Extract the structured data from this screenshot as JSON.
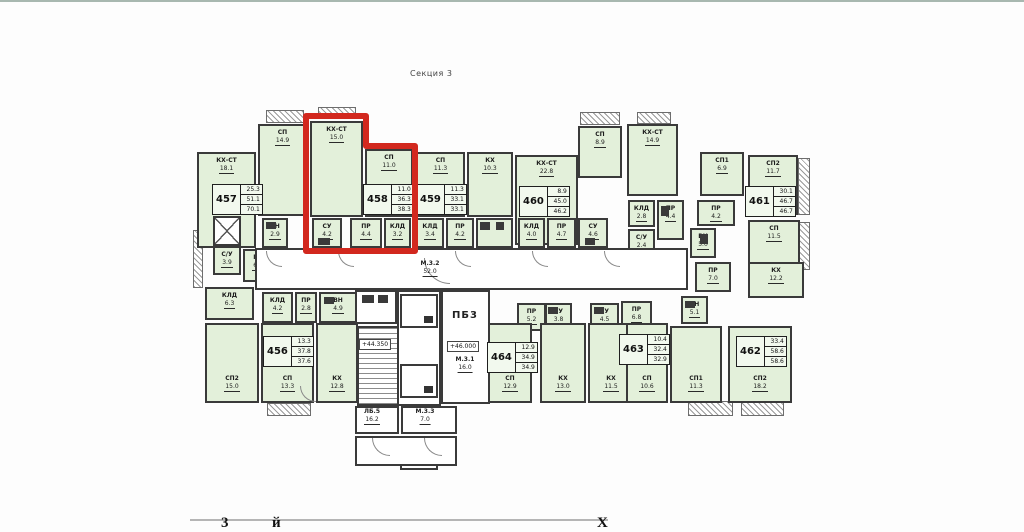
{
  "title": "Секция 3",
  "highlight": {
    "apartment": "458",
    "color": "#d2281e"
  },
  "rooms": [
    {
      "nm": "КХ-СТ",
      "ar": "18.1",
      "x": 197,
      "y": 152,
      "w": 59,
      "h": 96
    },
    {
      "nm": "СП",
      "ar": "14.9",
      "x": 258,
      "y": 124,
      "w": 49,
      "h": 92
    },
    {
      "nm": "КХ-СТ",
      "ar": "15.0",
      "x": 310,
      "y": 121,
      "w": 53,
      "h": 96
    },
    {
      "nm": "СП",
      "ar": "11.0",
      "x": 365,
      "y": 149,
      "w": 48,
      "h": 68
    },
    {
      "nm": "СП",
      "ar": "11.3",
      "x": 416,
      "y": 152,
      "w": 49,
      "h": 65
    },
    {
      "nm": "КХ",
      "ar": "10.3",
      "x": 467,
      "y": 152,
      "w": 46,
      "h": 65
    },
    {
      "nm": "КХ-СТ",
      "ar": "22.8",
      "x": 515,
      "y": 155,
      "w": 63,
      "h": 90
    },
    {
      "nm": "СП",
      "ar": "8.9",
      "x": 578,
      "y": 126,
      "w": 44,
      "h": 52
    },
    {
      "nm": "КХ-СТ",
      "ar": "14.9",
      "x": 627,
      "y": 124,
      "w": 51,
      "h": 72
    },
    {
      "nm": "СП1",
      "ar": "6.9",
      "x": 700,
      "y": 152,
      "w": 44,
      "h": 44
    },
    {
      "nm": "СП2",
      "ar": "11.7",
      "x": 748,
      "y": 155,
      "w": 50,
      "h": 60
    },
    {
      "nm": "СП",
      "ar": "11.5",
      "x": 748,
      "y": 220,
      "w": 52,
      "h": 50
    },
    {
      "nm": "ВН",
      "ar": "2.9",
      "x": 262,
      "y": 218,
      "w": 26,
      "h": 30
    },
    {
      "nm": "СУ",
      "ar": "4.2",
      "x": 312,
      "y": 218,
      "w": 30,
      "h": 30
    },
    {
      "nm": "ПР",
      "ar": "4.4",
      "x": 350,
      "y": 218,
      "w": 32,
      "h": 30
    },
    {
      "nm": "КЛД",
      "ar": "3.2",
      "x": 384,
      "y": 218,
      "w": 27,
      "h": 30
    },
    {
      "nm": "КЛД",
      "ar": "3.4",
      "x": 416,
      "y": 218,
      "w": 28,
      "h": 30
    },
    {
      "nm": "ПР",
      "ar": "4.2",
      "x": 446,
      "y": 218,
      "w": 28,
      "h": 30
    },
    {
      "nm": "",
      "ar": "",
      "x": 476,
      "y": 218,
      "w": 37,
      "h": 30
    },
    {
      "nm": "КЛД",
      "ar": "4.0",
      "x": 518,
      "y": 218,
      "w": 27,
      "h": 30
    },
    {
      "nm": "ПР",
      "ar": "4.7",
      "x": 547,
      "y": 218,
      "w": 29,
      "h": 30
    },
    {
      "nm": "СУ",
      "ar": "4.6",
      "x": 578,
      "y": 218,
      "w": 30,
      "h": 30
    },
    {
      "nm": "КЛД",
      "ar": "2.8",
      "x": 628,
      "y": 200,
      "w": 27,
      "h": 27
    },
    {
      "nm": "ПР",
      "ar": "4.4",
      "x": 657,
      "y": 200,
      "w": 27,
      "h": 40
    },
    {
      "nm": "С/У",
      "ar": "2.4",
      "x": 628,
      "y": 229,
      "w": 27,
      "h": 26
    },
    {
      "nm": "ПР",
      "ar": "4.2",
      "x": 697,
      "y": 200,
      "w": 38,
      "h": 26
    },
    {
      "nm": "ВН",
      "ar": "5.0",
      "x": 690,
      "y": 228,
      "w": 26,
      "h": 30
    },
    {
      "nm": "С/У",
      "ar": "3.9",
      "x": 213,
      "y": 246,
      "w": 28,
      "h": 29
    },
    {
      "nm": "ПР",
      "ar": "6.0",
      "x": 243,
      "y": 249,
      "w": 30,
      "h": 33
    },
    {
      "nm": "КЛД",
      "ar": "6.3",
      "x": 205,
      "y": 287,
      "w": 49,
      "h": 33
    },
    {
      "nm": "КЛД",
      "ar": "4.2",
      "x": 262,
      "y": 292,
      "w": 31,
      "h": 31
    },
    {
      "nm": "ПР",
      "ar": "2.8",
      "x": 295,
      "y": 292,
      "w": 22,
      "h": 31
    },
    {
      "nm": "ВН",
      "ar": "4.9",
      "x": 319,
      "y": 292,
      "w": 38,
      "h": 31
    },
    {
      "nm": "СП2",
      "ar": "15.0",
      "x": 205,
      "y": 323,
      "w": 54,
      "h": 80,
      "cls": "lb"
    },
    {
      "nm": "СП",
      "ar": "13.3",
      "x": 261,
      "y": 323,
      "w": 53,
      "h": 80,
      "cls": "lb"
    },
    {
      "nm": "КХ",
      "ar": "12.8",
      "x": 316,
      "y": 323,
      "w": 42,
      "h": 80,
      "cls": "lb"
    },
    {
      "nm": "ПР",
      "ar": "5.2",
      "x": 517,
      "y": 303,
      "w": 29,
      "h": 28
    },
    {
      "nm": "СУ",
      "ar": "3.8",
      "x": 545,
      "y": 303,
      "w": 27,
      "h": 28
    },
    {
      "nm": "СП",
      "ar": "12.9",
      "x": 488,
      "y": 323,
      "w": 44,
      "h": 80,
      "cls": "lb"
    },
    {
      "nm": "КХ",
      "ar": "13.0",
      "x": 540,
      "y": 323,
      "w": 46,
      "h": 80,
      "cls": "lb"
    },
    {
      "nm": "СУ",
      "ar": "4.5",
      "x": 590,
      "y": 303,
      "w": 29,
      "h": 28
    },
    {
      "nm": "ПР",
      "ar": "6.8",
      "x": 621,
      "y": 301,
      "w": 31,
      "h": 30
    },
    {
      "nm": "КХ",
      "ar": "11.5",
      "x": 588,
      "y": 323,
      "w": 46,
      "h": 80,
      "cls": "lb"
    },
    {
      "nm": "СП",
      "ar": "10.6",
      "x": 626,
      "y": 323,
      "w": 42,
      "h": 80,
      "cls": "lb"
    },
    {
      "nm": "ПР",
      "ar": "7.0",
      "x": 695,
      "y": 262,
      "w": 36,
      "h": 30
    },
    {
      "nm": "КХ",
      "ar": "12.2",
      "x": 748,
      "y": 262,
      "w": 56,
      "h": 36
    },
    {
      "nm": "ВН",
      "ar": "5.1",
      "x": 681,
      "y": 296,
      "w": 27,
      "h": 28
    },
    {
      "nm": "СП1",
      "ar": "11.3",
      "x": 670,
      "y": 326,
      "w": 52,
      "h": 77,
      "cls": "lb"
    },
    {
      "nm": "СП2",
      "ar": "18.2",
      "x": 728,
      "y": 326,
      "w": 64,
      "h": 77,
      "cls": "lb"
    },
    {
      "nm": "",
      "ar": "",
      "x": 255,
      "y": 248,
      "w": 433,
      "h": 42,
      "cls": "core"
    },
    {
      "nm": "",
      "ar": "",
      "x": 355,
      "y": 290,
      "w": 42,
      "h": 34,
      "cls": "core"
    },
    {
      "nm": "",
      "ar": "",
      "x": 397,
      "y": 290,
      "w": 44,
      "h": 116,
      "cls": "core"
    },
    {
      "nm": "",
      "ar": "",
      "x": 400,
      "y": 294,
      "w": 38,
      "h": 34,
      "cls": "core lift"
    },
    {
      "nm": "",
      "ar": "",
      "x": 400,
      "y": 330,
      "w": 38,
      "h": 34,
      "cls": "core lift"
    },
    {
      "nm": "",
      "ar": "",
      "x": 400,
      "y": 368,
      "w": 38,
      "h": 34,
      "cls": "core lift"
    },
    {
      "nm": "",
      "ar": "",
      "x": 441,
      "y": 290,
      "w": 49,
      "h": 114,
      "cls": "core"
    },
    {
      "nm": "",
      "ar": "",
      "x": 357,
      "y": 326,
      "w": 42,
      "h": 80,
      "cls": "stairs"
    },
    {
      "nm": "",
      "ar": "",
      "x": 355,
      "y": 406,
      "w": 44,
      "h": 28,
      "cls": "core"
    },
    {
      "nm": "",
      "ar": "",
      "x": 401,
      "y": 406,
      "w": 56,
      "h": 28,
      "cls": "core"
    },
    {
      "nm": "",
      "ar": "",
      "x": 355,
      "y": 436,
      "w": 102,
      "h": 30,
      "cls": "core"
    },
    {
      "nm": "",
      "ar": "",
      "x": 213,
      "y": 216,
      "w": 28,
      "h": 30,
      "cls": "core shaft"
    }
  ],
  "balconies": [
    {
      "x": 266,
      "y": 110,
      "w": 38,
      "h": 13
    },
    {
      "x": 318,
      "y": 107,
      "w": 38,
      "h": 12
    },
    {
      "x": 580,
      "y": 112,
      "w": 40,
      "h": 13
    },
    {
      "x": 637,
      "y": 112,
      "w": 34,
      "h": 12
    },
    {
      "x": 267,
      "y": 403,
      "w": 44,
      "h": 13
    },
    {
      "x": 688,
      "y": 401,
      "w": 45,
      "h": 15
    },
    {
      "x": 741,
      "y": 401,
      "w": 43,
      "h": 15
    },
    {
      "x": 193,
      "y": 230,
      "w": 10,
      "h": 58
    },
    {
      "x": 798,
      "y": 158,
      "w": 12,
      "h": 57
    },
    {
      "x": 798,
      "y": 222,
      "w": 12,
      "h": 48
    }
  ],
  "apartments": [
    {
      "num": "457",
      "areas": [
        "25.3",
        "51.1",
        "70.1"
      ],
      "x": 212,
      "y": 184
    },
    {
      "num": "458",
      "areas": [
        "11.0",
        "36.3",
        "38.3"
      ],
      "x": 363,
      "y": 184
    },
    {
      "num": "459",
      "areas": [
        "11.3",
        "33.1",
        "33.1"
      ],
      "x": 416,
      "y": 184
    },
    {
      "num": "460",
      "areas": [
        "8.9",
        "45.0",
        "46.2"
      ],
      "x": 519,
      "y": 186
    },
    {
      "num": "461",
      "areas": [
        "30.1",
        "46.7",
        "46.7"
      ],
      "x": 745,
      "y": 186
    },
    {
      "num": "456",
      "areas": [
        "13.3",
        "37.8",
        "37.6"
      ],
      "x": 263,
      "y": 336
    },
    {
      "num": "464",
      "areas": [
        "12.9",
        "34.9",
        "34.9"
      ],
      "x": 487,
      "y": 342
    },
    {
      "num": "463",
      "areas": [
        "10.4",
        "32.4",
        "32.9"
      ],
      "x": 619,
      "y": 334
    },
    {
      "num": "462",
      "areas": [
        "33.4",
        "58.6",
        "58.6"
      ],
      "x": 736,
      "y": 336
    }
  ],
  "core_labels": [
    {
      "nm": "М.3.2",
      "ar": "52.0",
      "x": 430,
      "y": 260,
      "big": false
    },
    {
      "nm": "ПБ3",
      "ar": "",
      "x": 465,
      "y": 312,
      "big": true
    },
    {
      "nm": "М.3.1",
      "ar": "16.0",
      "x": 465,
      "y": 356,
      "big": false
    },
    {
      "nm": "ЛБ.5",
      "ar": "16.2",
      "x": 372,
      "y": 408,
      "big": false
    },
    {
      "nm": "М.3.3",
      "ar": "7.0",
      "x": 425,
      "y": 408,
      "big": false
    }
  ],
  "elevations": [
    {
      "t": "+44.350",
      "x": 375,
      "y": 339
    },
    {
      "t": "+46.000",
      "x": 463,
      "y": 341
    }
  ],
  "bottom_fragments": [
    {
      "t": "3",
      "x": 221
    },
    {
      "t": "й",
      "x": 272
    },
    {
      "t": "Х",
      "x": 597
    }
  ]
}
